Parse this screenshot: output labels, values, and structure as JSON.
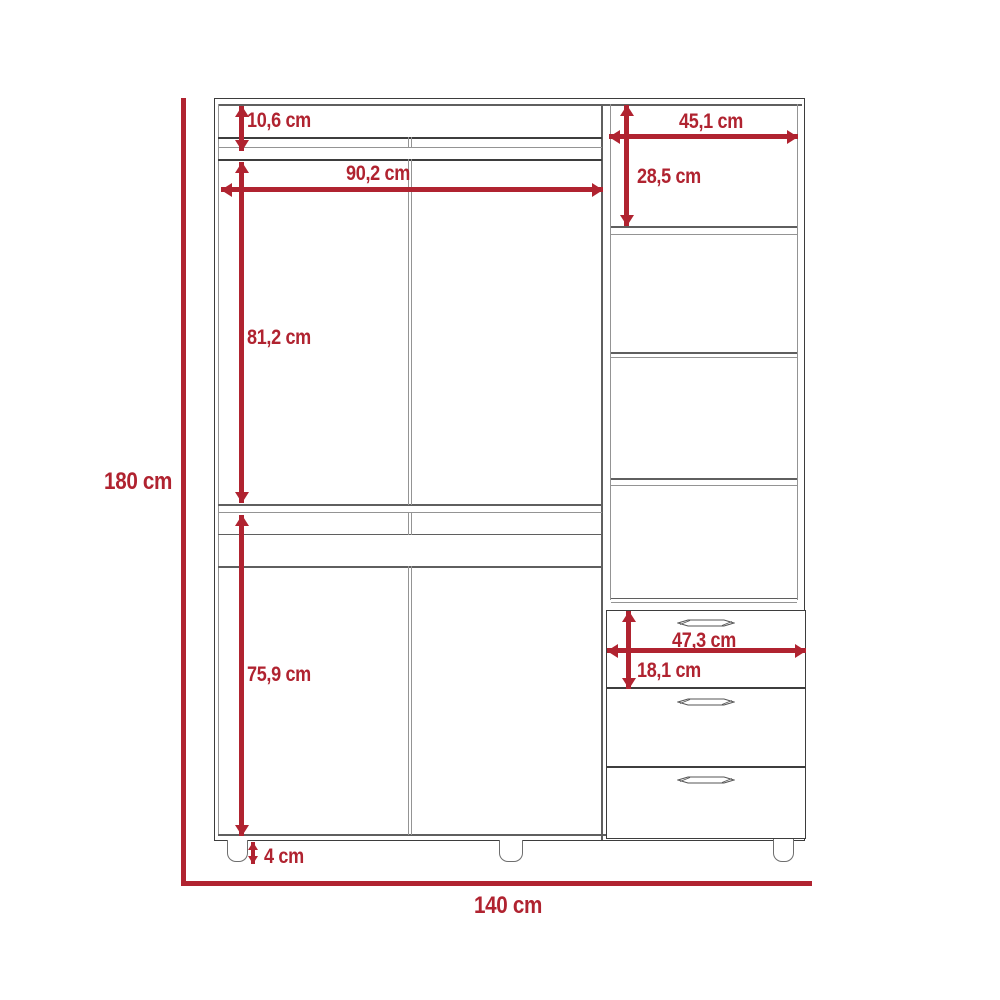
{
  "diagram": {
    "kind": "furniture-dimension-diagram",
    "unit": "cm",
    "colors": {
      "accent": "#b02330",
      "outline_dark": "#3d3d3d",
      "outline_light": "#949494"
    },
    "dims": {
      "overall_height": "180 cm",
      "overall_width": "140 cm",
      "top_opening_height": "10,6 cm",
      "left_section_width": "90,2 cm",
      "upper_door_height": "81,2 cm",
      "lower_door_height": "75,9 cm",
      "leg_height": "4 cm",
      "right_section_width": "45,1 cm",
      "right_opening_height": "28,5 cm",
      "drawer_width": "47,3 cm",
      "drawer_height": "18,1 cm"
    }
  }
}
